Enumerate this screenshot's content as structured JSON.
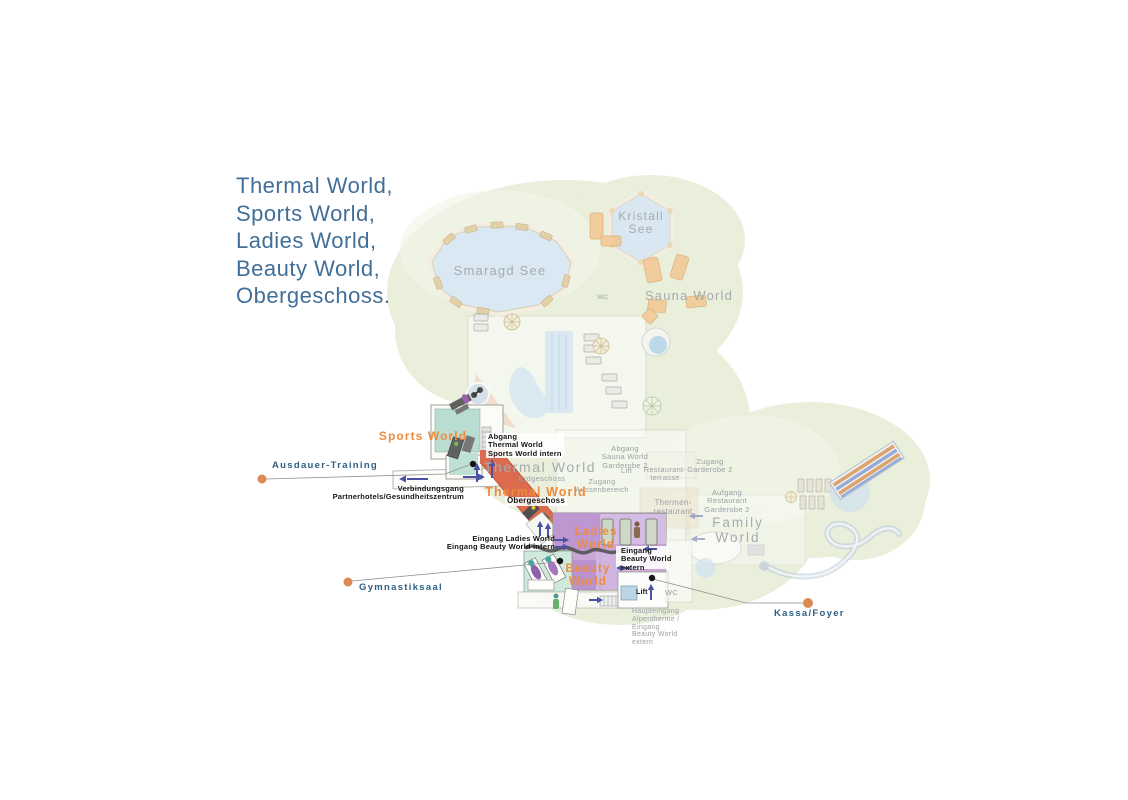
{
  "title": {
    "text": "Thermal World,\nSports World,\nLadies World,\nBeauty World,\nObergeschoss."
  },
  "callouts": {
    "ausdauer": "Ausdauer-Training",
    "gymnastiksaal": "Gymnastiksaal",
    "kassa": "Kassa/Foyer"
  },
  "areas": {
    "smaragd_see": "Smaragd See",
    "kristall_see": "Kristall\nSee",
    "sauna_world": "Sauna World",
    "sports_world": "Sports World",
    "thermal_world_erdgeschoss": "Thermal World",
    "erdgeschoss": "Erdgeschoss",
    "thermal_world_obergeschoss": "Thermal World",
    "obergeschoss": "Obergeschoss",
    "ladies_world": "Ladies\nWorld",
    "beauty_world": "Beauty\nWorld",
    "family_world": "Family\nWorld",
    "thermen_restaurant": "Thermen-\nrestaurant",
    "restaurant_terrasse": "Restaurant-\nterrasse"
  },
  "entrances": {
    "abgang_thermal": "Abgang\nThermal World\nSports World intern",
    "verbindungsgang": "Verbindungsgang\nPartnerhotels/Gesundheitszentrum",
    "eingang_ladies": "Eingang Ladies World\nEingang Beauty World intern",
    "eingang_beauty_extern": "Eingang\nBeauty World\nextern",
    "abgang_sauna": "Abgang\nSauna World\nGarderobe 2",
    "zugang_aussenbereich": "Zugang\nAussenbereich",
    "zugang_garderobe_2": "Zugang\nGarderobe 2",
    "aufgang_restaurant": "Aufgang\nRestaurant\nGarderobe 2",
    "haupteingang": "Haupteingang\nAlpentherme /\nEingang\nBeauty World\nextern",
    "lift_obergeschoss": "Lift",
    "lift_erdgeschoss": "Lift",
    "wc_sauna": "WC",
    "wc_foyer": "WC"
  },
  "colors": {
    "title_text": "#426f97",
    "callout_text": "#2c5f83",
    "world_label_orange": "#ee8b3c",
    "map_label_gray": "#a7abad",
    "highlight_corridor": "#db6a4e",
    "sports_world_fill": "#b9ddd1",
    "ladies_beauty_fill": "#c9a6d6",
    "greenery": "#e9efdb",
    "water": "#d6e6f1",
    "arrow_blue": "#4a52a4",
    "callout_dot_orange": "#dd8a52"
  }
}
